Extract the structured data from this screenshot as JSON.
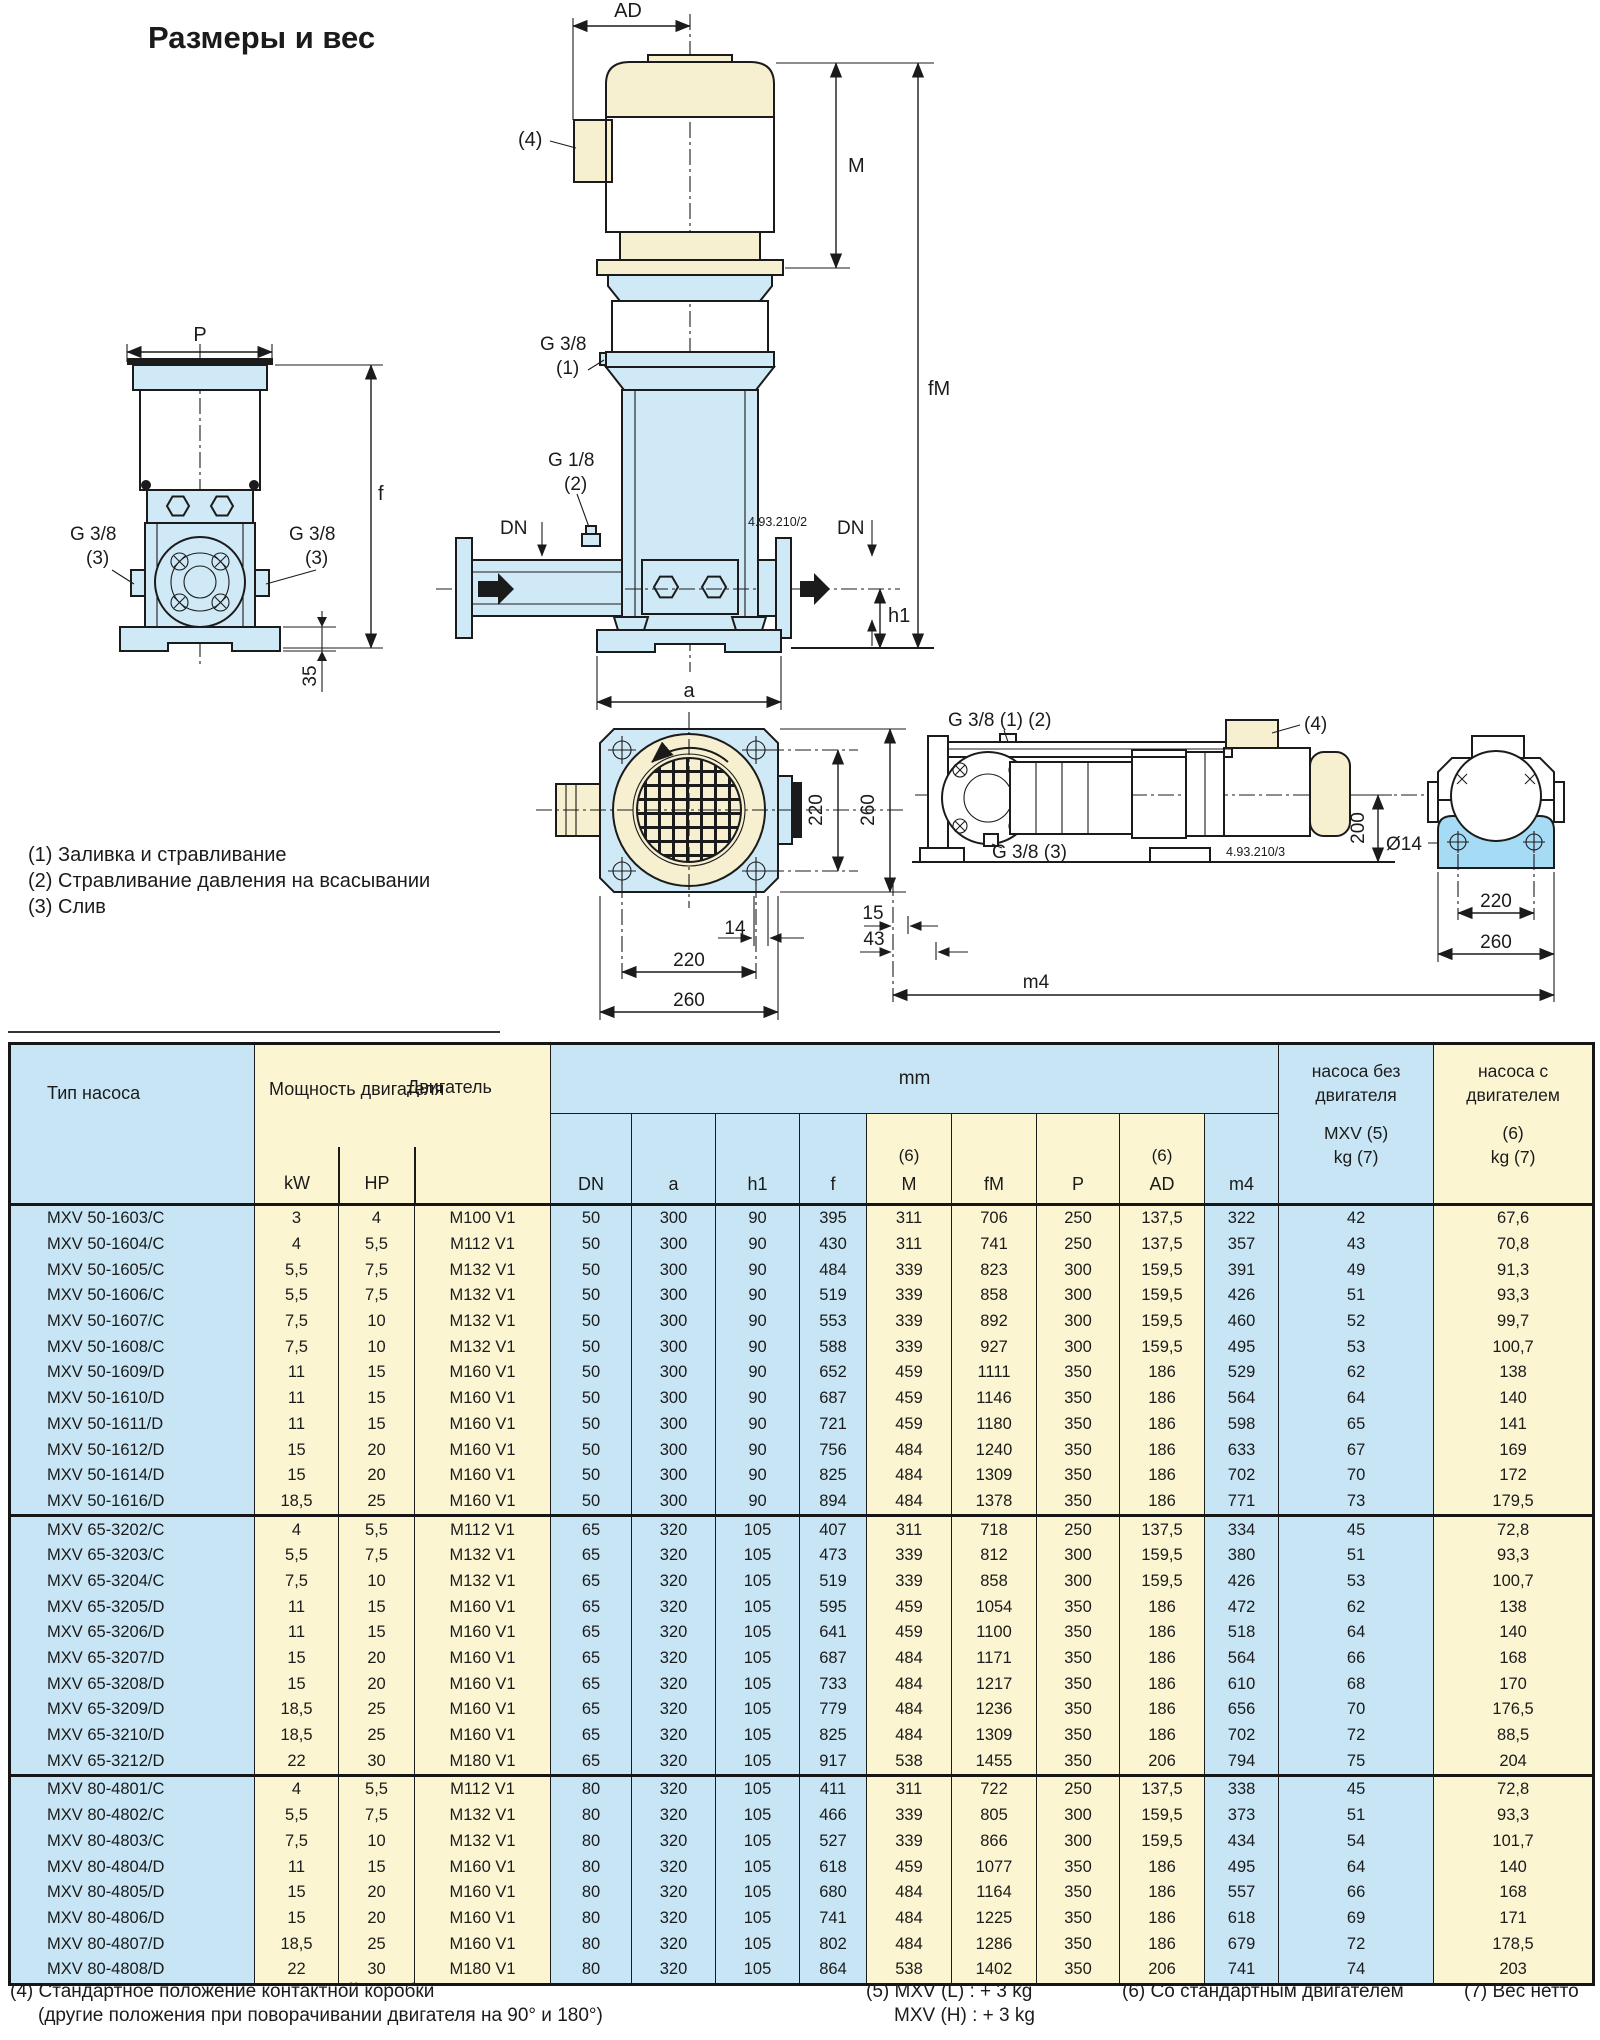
{
  "title": "Размеры и вес",
  "legend": {
    "item1": "(1) Заливка и стравливание",
    "item2": "(2) Стравливание давления на всасывании",
    "item3": "(3) Слив"
  },
  "drawings": {
    "front_view": {
      "dim_p": "P",
      "dim_f": "f",
      "dim_35": "35",
      "port_left_label": "G 3/8",
      "port_left_ref": "(3)",
      "port_right_label": "G 3/8",
      "port_right_ref": "(3)"
    },
    "side_view": {
      "dim_ad": "AD",
      "dim_m": "M",
      "dim_fm": "fM",
      "dim_dn_left": "DN",
      "dim_dn_right": "DN",
      "dim_h1": "h1",
      "dim_a": "a",
      "ref4": "(4)",
      "fill_label": "G 3/8",
      "fill_ref": "(1)",
      "vent_label": "G 1/8",
      "vent_ref": "(2)",
      "drawing_no": "4.93.210/2"
    },
    "top_view": {
      "dim_220_v": "220",
      "dim_260_v": "260",
      "dim_14": "14",
      "dim_220_h": "220",
      "dim_260_h": "260"
    },
    "horizontal_view": {
      "ports_label": "G 3/8 (1) (2)",
      "ref4": "(4)",
      "drain_label": "G 3/8 (3)",
      "dim_15": "15",
      "dim_43": "43",
      "dim_m4": "m4",
      "dim_200": "200",
      "dim_d14": "Ø14",
      "dim_220": "220",
      "dim_260": "260",
      "drawing_no": "4.93.210/3"
    }
  },
  "table": {
    "headers": {
      "type": "Тип насоса",
      "power": "Мощность двигателя",
      "motor": "Двигатель",
      "kw": "kW",
      "hp": "HP",
      "mm": "mm",
      "sup6": "(6)",
      "sub": [
        "DN",
        "a",
        "h1",
        "f",
        "M",
        "fM",
        "P",
        "AD",
        "m4"
      ],
      "kg_pump_1": "насоса без",
      "kg_pump_2": "двигателя",
      "kg_pump_3": "MXV (5)",
      "kg_pump_4": "kg (7)",
      "kg_unit_1": "насоса с",
      "kg_unit_2": "двигателем",
      "kg_unit_3": "(6)",
      "kg_unit_4": "kg (7)"
    },
    "groups": [
      {
        "rows": [
          [
            "MXV 50-1603/C",
            "3",
            "4",
            "M100 V1",
            "50",
            "300",
            "90",
            "395",
            "311",
            "706",
            "250",
            "137,5",
            "322",
            "42",
            "67,6"
          ],
          [
            "MXV 50-1604/C",
            "4",
            "5,5",
            "M112 V1",
            "50",
            "300",
            "90",
            "430",
            "311",
            "741",
            "250",
            "137,5",
            "357",
            "43",
            "70,8"
          ],
          [
            "MXV 50-1605/C",
            "5,5",
            "7,5",
            "M132 V1",
            "50",
            "300",
            "90",
            "484",
            "339",
            "823",
            "300",
            "159,5",
            "391",
            "49",
            "91,3"
          ],
          [
            "MXV 50-1606/C",
            "5,5",
            "7,5",
            "M132 V1",
            "50",
            "300",
            "90",
            "519",
            "339",
            "858",
            "300",
            "159,5",
            "426",
            "51",
            "93,3"
          ],
          [
            "MXV 50-1607/C",
            "7,5",
            "10",
            "M132 V1",
            "50",
            "300",
            "90",
            "553",
            "339",
            "892",
            "300",
            "159,5",
            "460",
            "52",
            "99,7"
          ],
          [
            "MXV 50-1608/C",
            "7,5",
            "10",
            "M132 V1",
            "50",
            "300",
            "90",
            "588",
            "339",
            "927",
            "300",
            "159,5",
            "495",
            "53",
            "100,7"
          ],
          [
            "MXV 50-1609/D",
            "11",
            "15",
            "M160 V1",
            "50",
            "300",
            "90",
            "652",
            "459",
            "1111",
            "350",
            "186",
            "529",
            "62",
            "138"
          ],
          [
            "MXV 50-1610/D",
            "11",
            "15",
            "M160 V1",
            "50",
            "300",
            "90",
            "687",
            "459",
            "1146",
            "350",
            "186",
            "564",
            "64",
            "140"
          ],
          [
            "MXV 50-1611/D",
            "11",
            "15",
            "M160 V1",
            "50",
            "300",
            "90",
            "721",
            "459",
            "1180",
            "350",
            "186",
            "598",
            "65",
            "141"
          ],
          [
            "MXV 50-1612/D",
            "15",
            "20",
            "M160 V1",
            "50",
            "300",
            "90",
            "756",
            "484",
            "1240",
            "350",
            "186",
            "633",
            "67",
            "169"
          ],
          [
            "MXV 50-1614/D",
            "15",
            "20",
            "M160 V1",
            "50",
            "300",
            "90",
            "825",
            "484",
            "1309",
            "350",
            "186",
            "702",
            "70",
            "172"
          ],
          [
            "MXV 50-1616/D",
            "18,5",
            "25",
            "M160 V1",
            "50",
            "300",
            "90",
            "894",
            "484",
            "1378",
            "350",
            "186",
            "771",
            "73",
            "179,5"
          ]
        ]
      },
      {
        "rows": [
          [
            "MXV 65-3202/C",
            "4",
            "5,5",
            "M112 V1",
            "65",
            "320",
            "105",
            "407",
            "311",
            "718",
            "250",
            "137,5",
            "334",
            "45",
            "72,8"
          ],
          [
            "MXV 65-3203/C",
            "5,5",
            "7,5",
            "M132 V1",
            "65",
            "320",
            "105",
            "473",
            "339",
            "812",
            "300",
            "159,5",
            "380",
            "51",
            "93,3"
          ],
          [
            "MXV 65-3204/C",
            "7,5",
            "10",
            "M132 V1",
            "65",
            "320",
            "105",
            "519",
            "339",
            "858",
            "300",
            "159,5",
            "426",
            "53",
            "100,7"
          ],
          [
            "MXV 65-3205/D",
            "11",
            "15",
            "M160 V1",
            "65",
            "320",
            "105",
            "595",
            "459",
            "1054",
            "350",
            "186",
            "472",
            "62",
            "138"
          ],
          [
            "MXV 65-3206/D",
            "11",
            "15",
            "M160 V1",
            "65",
            "320",
            "105",
            "641",
            "459",
            "1100",
            "350",
            "186",
            "518",
            "64",
            "140"
          ],
          [
            "MXV 65-3207/D",
            "15",
            "20",
            "M160 V1",
            "65",
            "320",
            "105",
            "687",
            "484",
            "1171",
            "350",
            "186",
            "564",
            "66",
            "168"
          ],
          [
            "MXV 65-3208/D",
            "15",
            "20",
            "M160 V1",
            "65",
            "320",
            "105",
            "733",
            "484",
            "1217",
            "350",
            "186",
            "610",
            "68",
            "170"
          ],
          [
            "MXV 65-3209/D",
            "18,5",
            "25",
            "M160 V1",
            "65",
            "320",
            "105",
            "779",
            "484",
            "1236",
            "350",
            "186",
            "656",
            "70",
            "176,5"
          ],
          [
            "MXV 65-3210/D",
            "18,5",
            "25",
            "M160 V1",
            "65",
            "320",
            "105",
            "825",
            "484",
            "1309",
            "350",
            "186",
            "702",
            "72",
            "88,5"
          ],
          [
            "MXV 65-3212/D",
            "22",
            "30",
            "M180 V1",
            "65",
            "320",
            "105",
            "917",
            "538",
            "1455",
            "350",
            "206",
            "794",
            "75",
            "204"
          ]
        ]
      },
      {
        "rows": [
          [
            "MXV 80-4801/C",
            "4",
            "5,5",
            "M112 V1",
            "80",
            "320",
            "105",
            "411",
            "311",
            "722",
            "250",
            "137,5",
            "338",
            "45",
            "72,8"
          ],
          [
            "MXV 80-4802/C",
            "5,5",
            "7,5",
            "M132 V1",
            "80",
            "320",
            "105",
            "466",
            "339",
            "805",
            "300",
            "159,5",
            "373",
            "51",
            "93,3"
          ],
          [
            "MXV 80-4803/C",
            "7,5",
            "10",
            "M132 V1",
            "80",
            "320",
            "105",
            "527",
            "339",
            "866",
            "300",
            "159,5",
            "434",
            "54",
            "101,7"
          ],
          [
            "MXV 80-4804/D",
            "11",
            "15",
            "M160 V1",
            "80",
            "320",
            "105",
            "618",
            "459",
            "1077",
            "350",
            "186",
            "495",
            "64",
            "140"
          ],
          [
            "MXV 80-4805/D",
            "15",
            "20",
            "M160 V1",
            "80",
            "320",
            "105",
            "680",
            "484",
            "1164",
            "350",
            "186",
            "557",
            "66",
            "168"
          ],
          [
            "MXV 80-4806/D",
            "15",
            "20",
            "M160 V1",
            "80",
            "320",
            "105",
            "741",
            "484",
            "1225",
            "350",
            "186",
            "618",
            "69",
            "171"
          ],
          [
            "MXV 80-4807/D",
            "18,5",
            "25",
            "M160 V1",
            "80",
            "320",
            "105",
            "802",
            "484",
            "1286",
            "350",
            "186",
            "679",
            "72",
            "178,5"
          ],
          [
            "MXV 80-4808/D",
            "22",
            "30",
            "M180 V1",
            "80",
            "320",
            "105",
            "864",
            "538",
            "1402",
            "350",
            "206",
            "741",
            "74",
            "203"
          ]
        ]
      }
    ]
  },
  "footnotes": {
    "fn4_line1": "(4) Стандартное положение контактной коробки",
    "fn4_line2": "(другие положения при поворачивании двигателя на 90° и 180°)",
    "fn5_line1": "(5) MXV (L) : + 3 kg",
    "fn5_line2": "MXV (H) : + 3 kg",
    "fn6": "(6) Со стандартным двигателем",
    "fn7": "(7) Вес нетто"
  }
}
